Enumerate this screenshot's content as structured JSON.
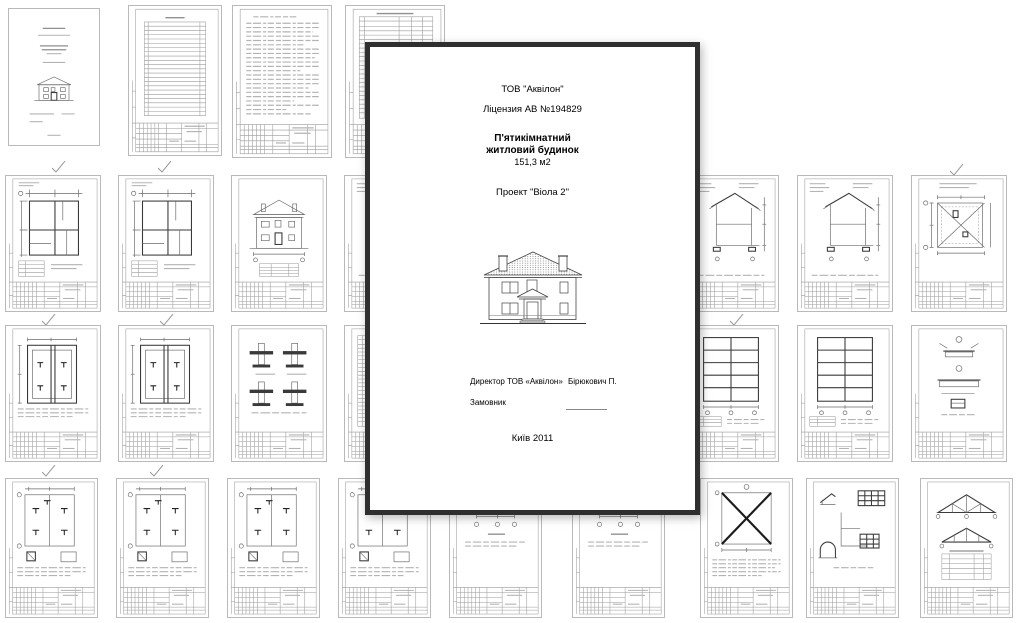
{
  "cover_page": {
    "company": "ТОВ \"Аквілон\"",
    "license": "Ліцензия АВ №194829",
    "title_line1": "П'ятикімнатний",
    "title_line2": "житловий будинок",
    "area": "151,3 м2",
    "project": "Проект \"Віола 2\"",
    "director_label": "Директор ТОВ «Аквілон»",
    "director_name": "Бірюкович П.",
    "customer_label": "Замовник",
    "city_year": "Київ 2011"
  },
  "colors": {
    "overlay_border": "#2f2f2f",
    "sheet_outline": "#b9b9b9",
    "drawing_line": "#6b6b6b"
  }
}
